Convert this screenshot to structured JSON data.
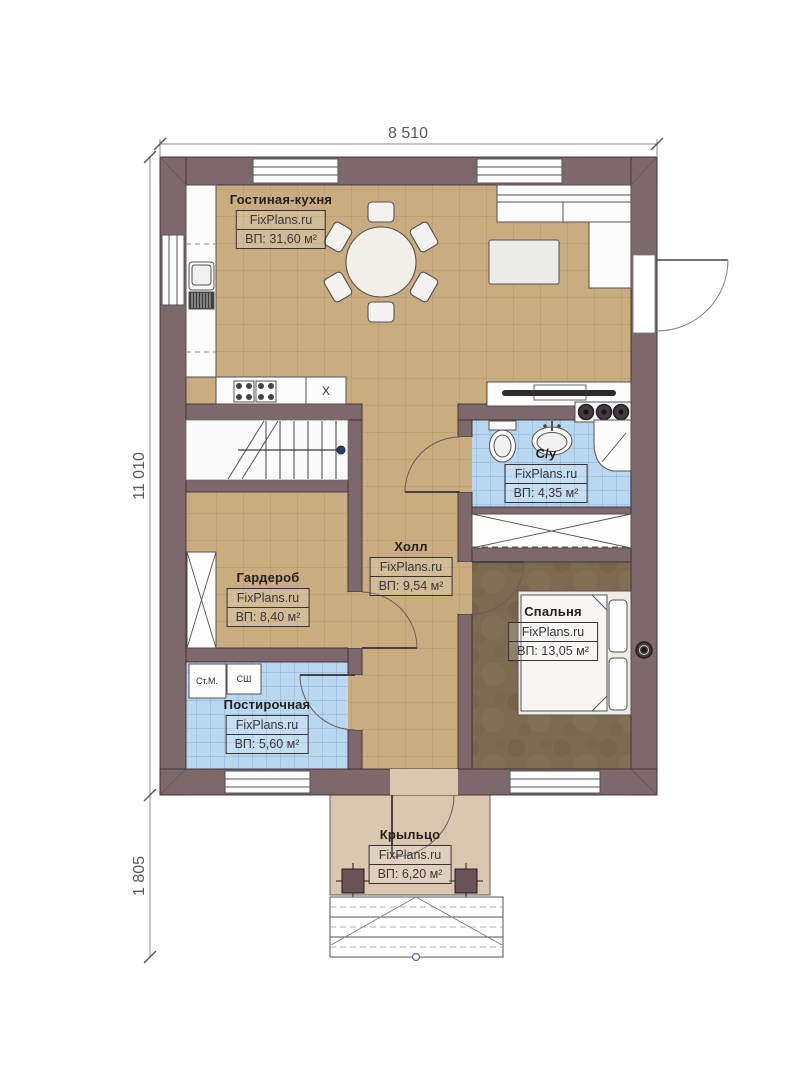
{
  "dimensions": {
    "width_top": "8 510",
    "height_left": "11 010",
    "porch_height_left": "1 805"
  },
  "rooms": {
    "living": {
      "name": "Гостиная-кухня",
      "brand": "FixPlans.ru",
      "area": "ВП: 31,60 м²"
    },
    "bathroom": {
      "name": "С/у",
      "brand": "FixPlans.ru",
      "area": "ВП: 4,35 м²"
    },
    "hall": {
      "name": "Холл",
      "brand": "FixPlans.ru",
      "area": "ВП: 9,54 м²"
    },
    "wardrobe": {
      "name": "Гардероб",
      "brand": "FixPlans.ru",
      "area": "ВП: 8,40 м²"
    },
    "bedroom": {
      "name": "Спальня",
      "brand": "FixPlans.ru",
      "area": "ВП: 13,05 м²"
    },
    "laundry": {
      "name": "Постирочная",
      "brand": "FixPlans.ru",
      "area": "ВП: 5,60 м²"
    },
    "porch": {
      "name": "Крыльцо",
      "brand": "FixPlans.ru",
      "area": "ВП: 6,20 м²"
    }
  },
  "appliances": {
    "washing_machine": "Ст.М.",
    "dryer": "СШ",
    "kitchen_unit": "X"
  },
  "colors": {
    "wall": "#7d686b",
    "wall_outline": "#3b2e32",
    "floor_tan": "#c9ad80",
    "floor_blue": "#b9d7ee",
    "floor_bedroom": "#7d6b51",
    "floor_porch": "#d9c7b0"
  }
}
